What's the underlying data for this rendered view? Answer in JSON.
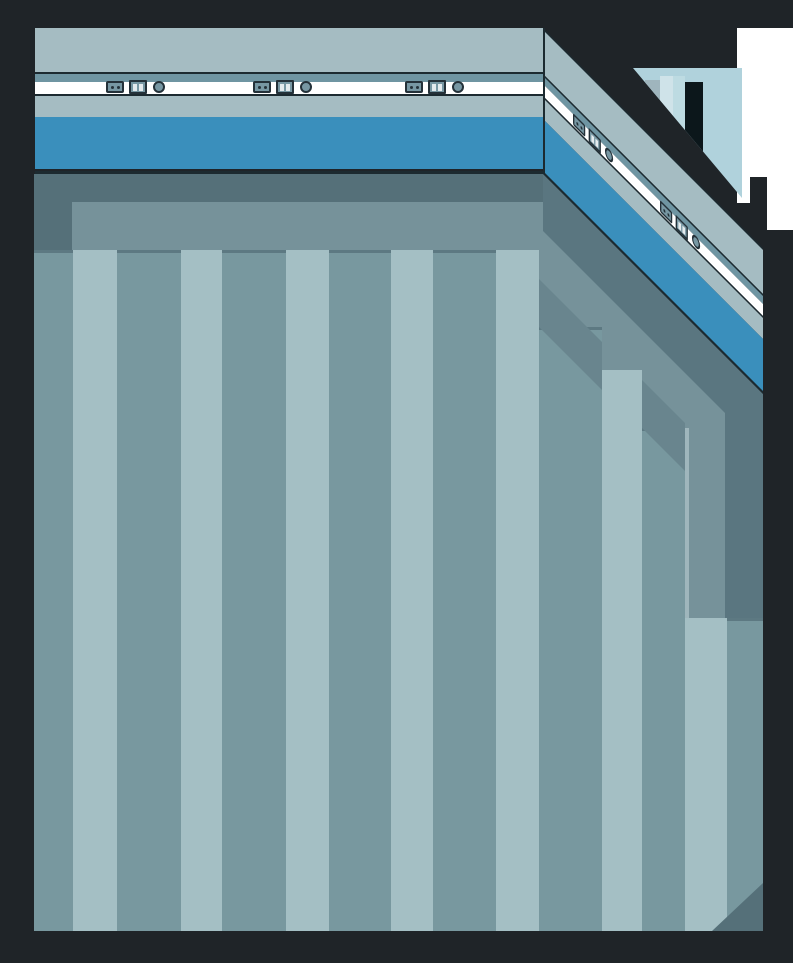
{
  "scene": {
    "type": "isometric-room-interior",
    "width": 793,
    "height": 963,
    "description": "Corner of a stylized room with striped floor, blue wainscot band, utility panels on white trim, diagonal side wall and a window view at top right"
  },
  "palette": {
    "background": "#1f2428",
    "outline": "#1c2a30",
    "wall_gray": "#a5bcc2",
    "wall_slate_strip": "#6f95a2",
    "wall_trim_white": "#ffffff",
    "wall_blue_band": "#3a8fbc",
    "floor_shadow": "#557079",
    "floor_border": "#76929a",
    "diagonal_shadow_band": "#5a7680",
    "stripe_medium": "#78989f",
    "stripe_light": "#a4bfc4",
    "stripe_top_edge": "#5d7982",
    "step_shadow": "#69858e",
    "edge_highlight": "#9fb6bc",
    "window_pale_blue": "#b0d2dc",
    "window_inner_strip_1": "#cfe3e9",
    "window_inner_strip_2": "#bddbe2",
    "window_column_gray": "#9fb5bd",
    "doorway_dark": "#0c171b",
    "outside_white": "#ffffff",
    "panel_fill": "#7797a3",
    "panel_outline": "#243139",
    "switch_bar_light": "#e4ebee"
  },
  "front_wall": {
    "icon_groups": [
      {
        "left": 71
      },
      {
        "left": 218
      },
      {
        "left": 370
      }
    ]
  },
  "side_wall": {
    "skew_degrees": 45,
    "icon_groups": [
      {
        "left": 30
      },
      {
        "left": 117
      }
    ]
  },
  "panel_icons": [
    "power-outlet",
    "light-switch",
    "round-button"
  ],
  "floor": {
    "stripes": [
      {
        "left": 0,
        "width": 39,
        "shade": "medium",
        "top": 76
      },
      {
        "left": 39,
        "width": 44,
        "shade": "light",
        "top": 76
      },
      {
        "left": 83,
        "width": 64,
        "shade": "medium",
        "top": 76
      },
      {
        "left": 147,
        "width": 41,
        "shade": "light",
        "top": 76
      },
      {
        "left": 188,
        "width": 64,
        "shade": "medium",
        "top": 76
      },
      {
        "left": 252,
        "width": 43,
        "shade": "light",
        "top": 76
      },
      {
        "left": 295,
        "width": 62,
        "shade": "medium",
        "top": 76
      },
      {
        "left": 357,
        "width": 42,
        "shade": "light",
        "top": 76
      },
      {
        "left": 399,
        "width": 63,
        "shade": "medium",
        "top": 76
      },
      {
        "left": 462,
        "width": 43,
        "shade": "light",
        "top": 76
      },
      {
        "left": 505,
        "width": 63,
        "shade": "medium",
        "top": 153
      },
      {
        "left": 568,
        "width": 40,
        "shade": "light",
        "top": 196
      },
      {
        "left": 608,
        "width": 43,
        "shade": "medium",
        "top": 254
      },
      {
        "left": 651,
        "width": 42,
        "shade": "light",
        "top": 444
      },
      {
        "left": 693,
        "width": 36,
        "shade": "medium",
        "top": 444
      }
    ],
    "step_caps": [
      {
        "left": 505,
        "top": 105,
        "width": 63
      },
      {
        "left": 608,
        "top": 206,
        "width": 43
      }
    ]
  },
  "window": {
    "column": {
      "left": 12,
      "width": 15
    },
    "strips": [
      {
        "left": 27,
        "width": 13,
        "color_key": "window_inner_strip_1"
      },
      {
        "left": 40,
        "width": 12,
        "color_key": "window_inner_strip_2"
      }
    ],
    "doorway": {
      "left": 52,
      "width": 18
    }
  }
}
